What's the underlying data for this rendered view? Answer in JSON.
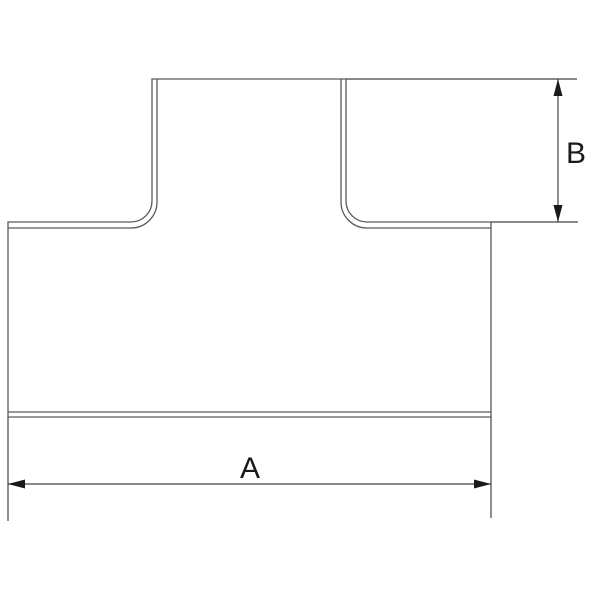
{
  "page": {
    "background": "#ffffff",
    "drawing_type": "technical line drawing",
    "subject": "pipe tee fitting, side elevation with dimension callouts"
  },
  "colors": {
    "outline": "#5a5a5a",
    "dimension_line": "#444444",
    "arrow": "#1a1a1a",
    "label": "#1a1a1a"
  },
  "dimensions": {
    "horizontal": {
      "label": "A",
      "measures": "overall width across the run (end to end)"
    },
    "vertical": {
      "label": "B",
      "measures": "branch height from top opening down to run shoulder"
    }
  }
}
